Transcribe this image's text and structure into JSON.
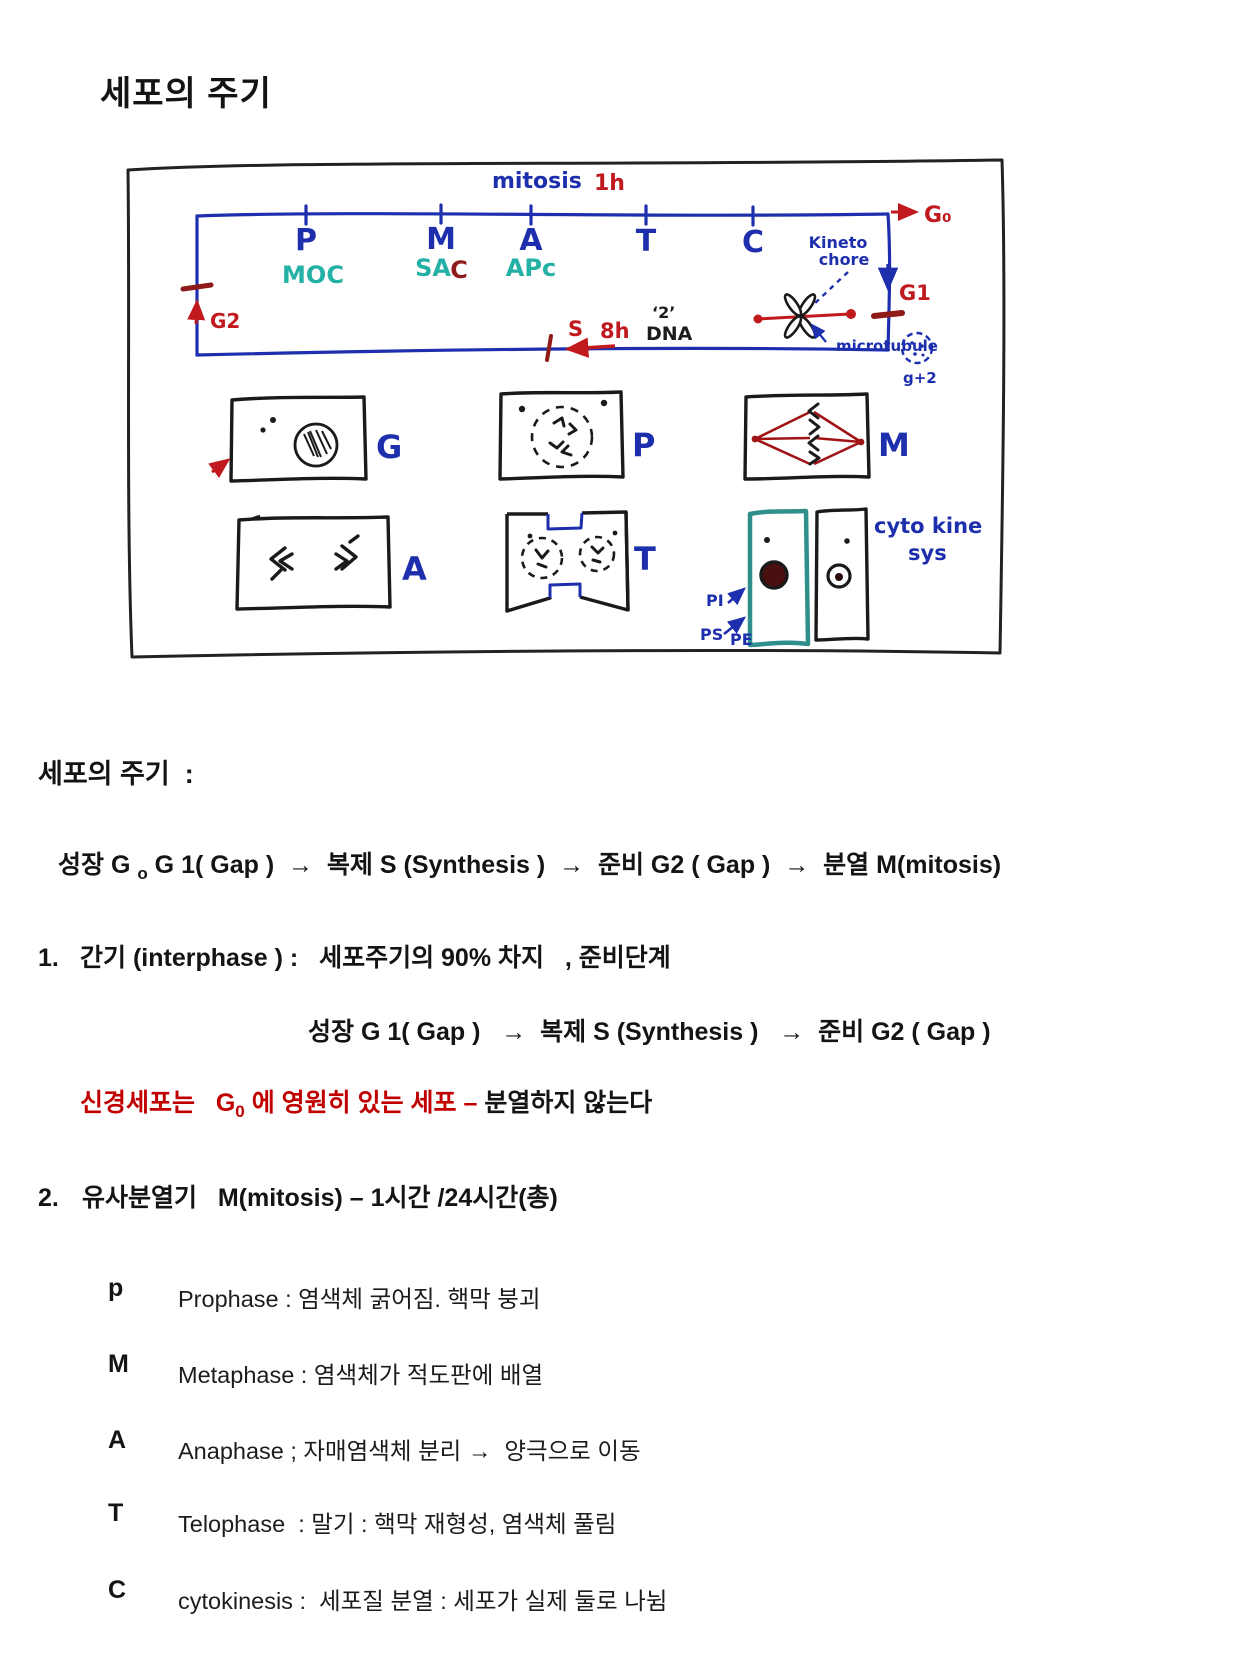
{
  "page": {
    "title": "세포의 주기"
  },
  "colors": {
    "pen_blue": "#1e2fae",
    "pen_red": "#c11a1e",
    "pen_teal": "#23b0a5",
    "pen_dark_red": "#8e1a1a",
    "ink_black": "#1c1c1c",
    "note_red": "#c00000",
    "cyto_teal": "#2e8f8b",
    "nucleus_maroon": "#4a0f0f"
  },
  "diagram": {
    "timeline": {
      "phases": [
        "P",
        "M",
        "A",
        "T",
        "C"
      ],
      "mitosis_label": "mitosis",
      "mitosis_duration": "1h",
      "g0_label": "G₀",
      "g1_label": "G1",
      "g2_label": "G2",
      "s_label": "S",
      "s_duration": "8h",
      "dna_copy": "‘2’",
      "dna_label": "DNA",
      "moc": "MOC",
      "sac_part1": "SA",
      "sac_part2": "C",
      "apc": "APc",
      "kineto_line1": "Kineto",
      "kineto_line2": "chore",
      "microtubule": "microtubule",
      "daughter_cell_note": "g+2"
    },
    "cells": {
      "g": "G",
      "p": "P",
      "m": "M",
      "a": "A",
      "t": "T",
      "cyto_line1": "cyto kine",
      "cyto_line2": "sys",
      "pi": "PI",
      "ps": "PS",
      "pe": "PE"
    }
  },
  "body": {
    "heading": "세포의 주기  :",
    "overview_flow": {
      "pre": "성장 G ",
      "sub": "o",
      "rest": " G 1( Gap )  →  복제 S (Synthesis )  →  준비 G2 ( Gap )  →  분열 M(mitosis)"
    },
    "section1": {
      "num": "1.",
      "title": "간기 (interphase ) :   세포주기의 90% 차지   , 준비단계",
      "flow": "성장 G 1( Gap )   →  복제 S (Synthesis )   →  준비 G2 ( Gap )"
    },
    "note": {
      "red_pre": "신경세포는   G",
      "red_sub": "0",
      "red_post": " 에 영원히 있는 세포 – ",
      "black": "분열하지 않는다"
    },
    "section2": {
      "num": "2.",
      "title": "유사분열기   M(mitosis) – 1시간 /24시간(총)"
    },
    "phases": [
      {
        "letter": "p",
        "name": "Prophase :",
        "desc": " 염색체 굵어짐. 핵막 붕괴"
      },
      {
        "letter": "M",
        "name": "Metaphase :",
        "desc": " 염색체가 적도판에 배열"
      },
      {
        "letter": "A",
        "name": "Anaphase ;",
        "desc": " 자매염색체 분리 →  양극으로 이동"
      },
      {
        "letter": "T",
        "name": "Telophase  :",
        "desc": " 말기 : 핵막 재형성, 염색체 풀림"
      },
      {
        "letter": "C",
        "name": "cytokinesis :",
        "desc": "  세포질 분열 : 세포가 실제 둘로 나뉨"
      }
    ]
  }
}
